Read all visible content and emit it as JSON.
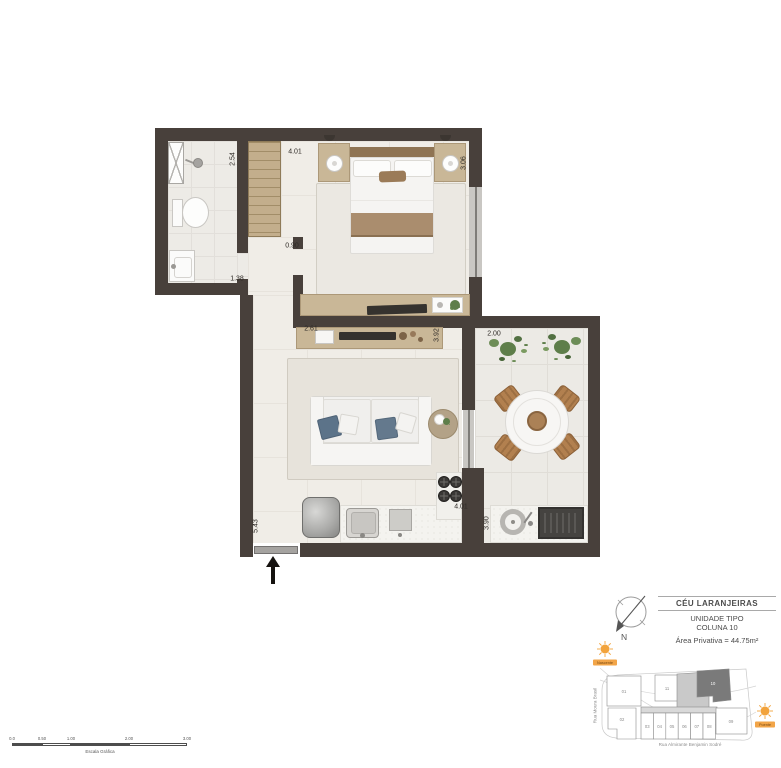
{
  "plan": {
    "dimensions": {
      "closet_side": "2.54",
      "bedroom_top": "4.01",
      "bedroom_right": "3.06",
      "hall_width": "0.90",
      "bathroom_width": "1.38",
      "sideboard_width": "2.61",
      "living_right": "3.92",
      "balcony_top": "2.00",
      "living_left": "5.43",
      "kitchen_width": "4.01",
      "balcony_right": "3.90"
    }
  },
  "title_block": {
    "project_name": "CÉU LARANJEIRAS",
    "unit_type": "UNIDADE TIPO",
    "unit_column": "COLUNA 10",
    "private_area": "Área Privativa = 44.75m²",
    "compass_north": "N"
  },
  "site_plan": {
    "street_left": "Rua Moura Brasil",
    "street_bottom": "Rua Almirante Benjamin Sodré",
    "sun_east": "Nascente",
    "sun_west": "Poente",
    "units": {
      "u01": "01",
      "u11": "11",
      "u10": "10",
      "u02": "02",
      "u03": "03",
      "u04": "04",
      "u05": "05",
      "u06": "06",
      "u07": "07",
      "u08": "08",
      "u09": "09"
    }
  },
  "scale_bar": {
    "ticks": [
      "0.0",
      "0.50",
      "1.00",
      "2.00",
      "3.00"
    ],
    "caption": "Escala Gráfica"
  },
  "colors": {
    "wall": "#48403b",
    "furniture_tan": "#c9b797",
    "highlighted_unit": "#7a7a7a",
    "shaded_unit": "#c9c9c9",
    "sun_orange": "#f2a33c",
    "pillow_blue": "#5c7389",
    "plant_green": "#5e7e4a"
  }
}
